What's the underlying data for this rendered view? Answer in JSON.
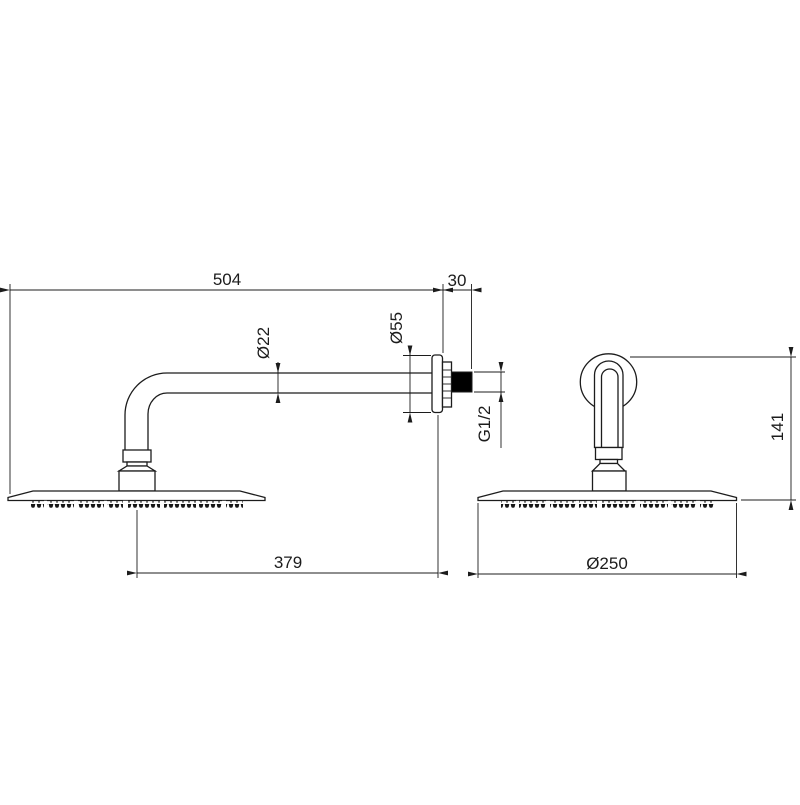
{
  "drawing": {
    "type": "technical-drawing",
    "subject": "wall-mounted rain shower head with arm, side and front views",
    "views": {
      "side": {
        "labels": {
          "projection": "504",
          "wall_offset": "30",
          "pipe_diameter": "Ø22",
          "flange_diameter": "Ø55",
          "thread_size": "G1/2",
          "head_offset": "379"
        }
      },
      "front": {
        "labels": {
          "drop_height": "141",
          "head_diameter": "Ø250"
        }
      }
    },
    "colors": {
      "line": "#1c1c1c",
      "background": "#ffffff",
      "thread_fill": "#000000"
    }
  }
}
